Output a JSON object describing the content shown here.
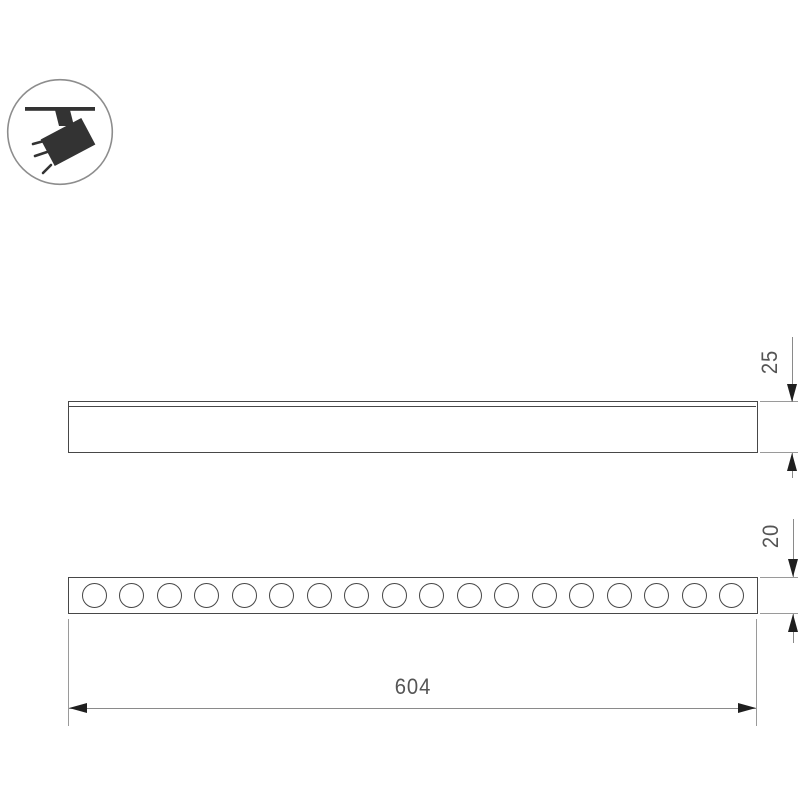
{
  "drawing": {
    "background": "#ffffff",
    "icon": {
      "type": "track-spotlight"
    },
    "views": {
      "side_profile": {
        "has_top_flange": true
      },
      "front": {
        "led_count": 18
      }
    },
    "dimensions": {
      "profile_height_mm": "25",
      "front_height_mm": "20",
      "length_mm": "604"
    },
    "colors": {
      "outline": "#474747",
      "dimension_line": "#8a8a8a",
      "extension_line": "#9a9a9a",
      "arrow": "#1f1f1f",
      "label": "#555555",
      "icon_fill": "#333333",
      "icon_circle_stroke": "#8d8d8d"
    }
  }
}
